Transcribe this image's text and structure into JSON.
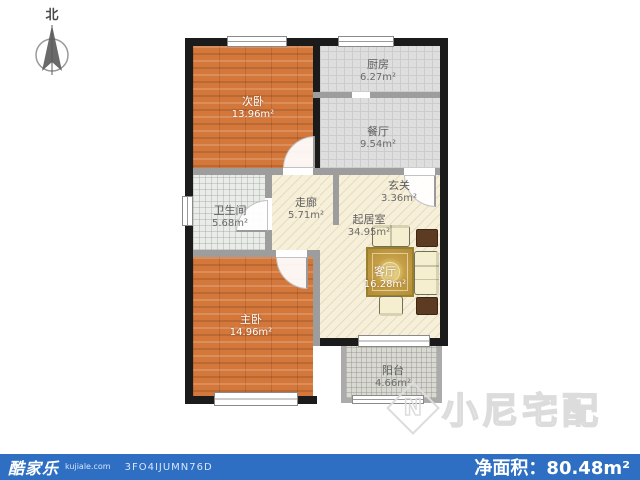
{
  "north": {
    "label": "北"
  },
  "rooms": [
    {
      "id": "ciwo",
      "name": "次卧",
      "area": "13.96m²"
    },
    {
      "id": "chufang",
      "name": "厨房",
      "area": "6.27m²"
    },
    {
      "id": "canting",
      "name": "餐厅",
      "area": "9.54m²"
    },
    {
      "id": "weishengjian",
      "name": "卫生间",
      "area": "5.68m²"
    },
    {
      "id": "zoulang",
      "name": "走廊",
      "area": "5.71m²"
    },
    {
      "id": "xuanguan",
      "name": "玄关",
      "area": "3.36m²"
    },
    {
      "id": "qijushi",
      "name": "起居室",
      "area": "34.95m²"
    },
    {
      "id": "keting",
      "name": "客厅",
      "area": "16.28m²"
    },
    {
      "id": "zhuwo",
      "name": "主卧",
      "area": "14.96m²"
    },
    {
      "id": "yangtai",
      "name": "阳台",
      "area": "4.66m²"
    }
  ],
  "footer": {
    "brand": "酷家乐",
    "site": "kujiale.com",
    "code": "3FO4IJUMN76D",
    "area_label": "净面积：",
    "area_value": "80.48m²"
  },
  "watermark": {
    "logo_letter": "N",
    "text": "小尼宅配"
  },
  "colors": {
    "footer_blue": "#2e6fc3",
    "wood_orange": "#d4773b",
    "floor_cream": "#f6efd9",
    "tile_gray": "#dedede",
    "rug_gold": "#c6a047",
    "wall_black": "#1b1b1b",
    "wall_gray": "#9d9d9d"
  }
}
